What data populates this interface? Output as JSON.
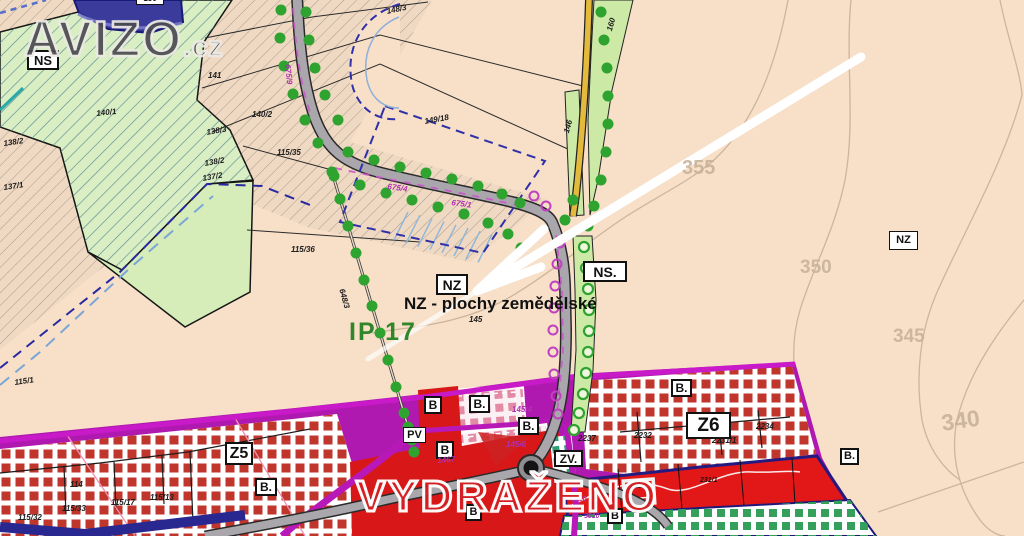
{
  "branding": {
    "logo_text": "AVIZO",
    "logo_suffix": ".cz",
    "diagonal_watermark": "VYDRAŽENO"
  },
  "callout": {
    "description": "NZ - plochy zemědělské",
    "green_feature_label": "IP 17"
  },
  "zone_boxes": [
    {
      "label": "NS",
      "x": 27,
      "y": 50,
      "w": 32,
      "h": 20,
      "fs": 13,
      "bw": 2
    },
    {
      "label": "NZ",
      "x": 436,
      "y": 274,
      "w": 32,
      "h": 21,
      "fs": 14,
      "bw": 2
    },
    {
      "label": "NS.",
      "x": 583,
      "y": 261,
      "w": 44,
      "h": 21,
      "fs": 14,
      "bw": 2
    },
    {
      "label": "NZ",
      "x": 889,
      "y": 231,
      "w": 29,
      "h": 19,
      "fs": 11,
      "bw": 1.5
    },
    {
      "label": "Z5",
      "x": 225,
      "y": 442,
      "w": 28,
      "h": 23,
      "fs": 16,
      "bw": 2
    },
    {
      "label": "Z6",
      "x": 686,
      "y": 412,
      "w": 45,
      "h": 27,
      "fs": 19,
      "bw": 2.5
    },
    {
      "label": "ZV.",
      "x": 554,
      "y": 450,
      "w": 29,
      "h": 17,
      "fs": 12,
      "bw": 2
    },
    {
      "label": "B",
      "x": 424,
      "y": 396,
      "w": 18,
      "h": 18,
      "fs": 12,
      "bw": 2
    },
    {
      "label": "B",
      "x": 436,
      "y": 441,
      "w": 18,
      "h": 18,
      "fs": 12,
      "bw": 2
    },
    {
      "label": "B",
      "x": 465,
      "y": 504,
      "w": 17,
      "h": 17,
      "fs": 11,
      "bw": 2
    },
    {
      "label": "B",
      "x": 607,
      "y": 508,
      "w": 16,
      "h": 16,
      "fs": 11,
      "bw": 2
    },
    {
      "label": "B.",
      "x": 469,
      "y": 395,
      "w": 21,
      "h": 18,
      "fs": 12,
      "bw": 2
    },
    {
      "label": "B.",
      "x": 518,
      "y": 417,
      "w": 21,
      "h": 18,
      "fs": 12,
      "bw": 2
    },
    {
      "label": "B.",
      "x": 671,
      "y": 379,
      "w": 21,
      "h": 18,
      "fs": 12,
      "bw": 2
    },
    {
      "label": "B.",
      "x": 255,
      "y": 478,
      "w": 22,
      "h": 18,
      "fs": 12,
      "bw": 2
    },
    {
      "label": "B.",
      "x": 840,
      "y": 448,
      "w": 19,
      "h": 17,
      "fs": 11,
      "bw": 2
    },
    {
      "label": "PV",
      "x": 403,
      "y": 427,
      "w": 23,
      "h": 16,
      "fs": 11,
      "bw": 1.5
    },
    {
      "label": "150",
      "x": 136,
      "y": -8,
      "w": 28,
      "h": 13,
      "fs": 8,
      "bw": 1.5
    }
  ],
  "parcel_labels": [
    {
      "t": "140/1",
      "x": 96,
      "y": 110,
      "r": -6
    },
    {
      "t": "141",
      "x": 208,
      "y": 72
    },
    {
      "t": "140/2",
      "x": 252,
      "y": 111
    },
    {
      "t": "148/3",
      "x": 386,
      "y": 8,
      "r": -12
    },
    {
      "t": "149/18",
      "x": 424,
      "y": 118,
      "r": -10
    },
    {
      "t": "146",
      "x": 563,
      "y": 132,
      "r": -75
    },
    {
      "t": "160",
      "x": 606,
      "y": 30,
      "r": -75
    },
    {
      "t": "115/35",
      "x": 277,
      "y": 149
    },
    {
      "t": "115/36",
      "x": 291,
      "y": 246
    },
    {
      "t": "115/1",
      "x": 14,
      "y": 379,
      "r": -8
    },
    {
      "t": "138/2",
      "x": 3,
      "y": 140,
      "r": -8
    },
    {
      "t": "137/1",
      "x": 3,
      "y": 184,
      "r": -8
    },
    {
      "t": "138/3",
      "x": 206,
      "y": 129,
      "r": -10
    },
    {
      "t": "138/2",
      "x": 204,
      "y": 160,
      "r": -10
    },
    {
      "t": "137/2",
      "x": 202,
      "y": 175,
      "r": -10
    },
    {
      "t": "145",
      "x": 469,
      "y": 316
    },
    {
      "t": "114",
      "x": 70,
      "y": 481
    },
    {
      "t": "115/33",
      "x": 62,
      "y": 505
    },
    {
      "t": "115/17",
      "x": 111,
      "y": 499
    },
    {
      "t": "115/13",
      "x": 150,
      "y": 494
    },
    {
      "t": "115/32",
      "x": 18,
      "y": 514
    },
    {
      "t": "2237",
      "x": 578,
      "y": 435
    },
    {
      "t": "2232",
      "x": 634,
      "y": 432
    },
    {
      "t": "2231/1",
      "x": 712,
      "y": 437
    },
    {
      "t": "2234",
      "x": 756,
      "y": 423
    },
    {
      "t": "675/4",
      "x": 388,
      "y": 183,
      "r": 8,
      "c": "#b030b0"
    },
    {
      "t": "675/1",
      "x": 452,
      "y": 199,
      "r": 8,
      "c": "#b030b0"
    },
    {
      "t": "675/9",
      "x": 291,
      "y": 64,
      "r": 84,
      "c": "#b030b0"
    },
    {
      "t": "648/3",
      "x": 345,
      "y": 288,
      "r": 74
    },
    {
      "t": "145/4",
      "x": 512,
      "y": 406,
      "c": "#b030b0"
    },
    {
      "t": "145/6",
      "x": 506,
      "y": 441,
      "c": "#b030b0"
    },
    {
      "t": "1467",
      "x": 437,
      "y": 457,
      "r": -5,
      "c": "#b030b0"
    },
    {
      "t": "2230",
      "x": 571,
      "y": 496,
      "c": "#b030b0",
      "fs": 7
    },
    {
      "t": "3010",
      "x": 584,
      "y": 513,
      "c": "#b030b0",
      "fs": 7
    },
    {
      "t": "223/1",
      "x": 630,
      "y": 483,
      "c": "#200a0a",
      "fs": 7
    },
    {
      "t": "231/1",
      "x": 700,
      "y": 477,
      "c": "#200a0a",
      "fs": 7
    }
  ],
  "contour_labels": [
    {
      "t": "355",
      "x": 682,
      "y": 158,
      "fs": 20
    },
    {
      "t": "350",
      "x": 800,
      "y": 258,
      "fs": 19
    },
    {
      "t": "345",
      "x": 893,
      "y": 327,
      "fs": 19
    },
    {
      "t": "340",
      "x": 940,
      "y": 412,
      "fs": 23,
      "r": -8
    }
  ],
  "colors": {
    "background_beige": "#f7dfc8",
    "agricultural_green": "#d6edb9",
    "checker_red": "#c0352c",
    "urban_magenta": "#b019b0",
    "road_gray": "#a9a7ab",
    "road_yellow": "#e3ba3c",
    "dot_green": "#2fa32f",
    "watermark_red": "#d32024",
    "contour_tan": "#c9b29a",
    "boundary_navy_dash": "#2828a0"
  }
}
